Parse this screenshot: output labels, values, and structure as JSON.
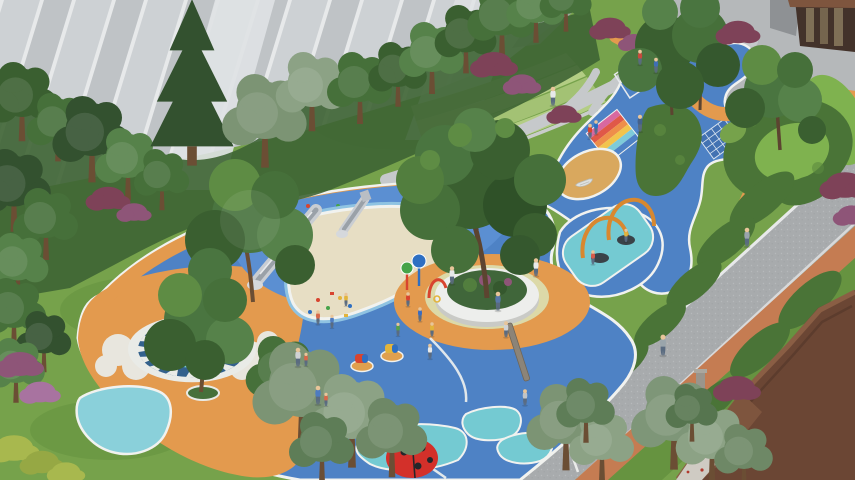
{
  "meta": {
    "title": "Residential courtyard children's playground — aerial 3D architectural rendering",
    "type": "3d-architectural-rendering",
    "view": "aerial-oblique"
  },
  "palette": {
    "grass": "#76A24B",
    "grass_dark": "#65913F",
    "lawn_bright": "#7FB24F",
    "terrace_light": "#B3CD84",
    "terrace_mid": "#A3C274",
    "terrace_dark": "#9CBB6E",
    "facade_base": "#C8CCCF",
    "facade_panel_a": "#CDD1D4",
    "facade_panel_b": "#BFC3C6",
    "facade_seam": "#E7E9EA",
    "facade_pillar": "#DFE2E4",
    "paving": "#B5B8BA",
    "path_grey": "#C6C9CB",
    "road": "#A8ABAD",
    "road_kerb": "#E8E9EA",
    "track_orange": "#C57C52",
    "play_blue": "#4E82C5",
    "hill_blue": "#5B8FD2",
    "deep_blue": "#2C64B0",
    "navy_ring": "#33618C",
    "teal": "#74CAD2",
    "teal_light": "#8AD0DA",
    "sand": "#E7DEC4",
    "sand_tan": "#D9A85E",
    "orange": "#E39A4E",
    "edge_white": "#F1F2EF",
    "cloud_white": "#E9EBE7",
    "hedge": "#4A7437",
    "hedge_light": "#5C8A40",
    "canopy_dark": "#3A5F30",
    "canopy_mid": "#46703A",
    "canopy_light": "#56824A",
    "canopy_pale": "#7C9474",
    "canopy_grey": "#8CA285",
    "conifer": "#33512F",
    "trunk_brown": "#6B4E34",
    "shrub_red": "#7E4258",
    "shrub_purple": "#8E5578",
    "bush_yellow": "#A8B84E",
    "roof_brown": "#6B4634",
    "roof_light": "#7E553E",
    "wood_dark": "#43322A",
    "glass_tint": "#8A7A5E",
    "metal_light": "#C9CDD2",
    "metal_dark": "#9AA1A8",
    "equip_red": "#D8442F",
    "equip_blue": "#2E6FC2",
    "equip_green": "#46A349",
    "equip_yellow": "#E2B43C",
    "arch_orange": "#D8882F",
    "ladybug_red": "#D3302A",
    "black": "#24262A",
    "skin": "#E8C59A",
    "white_shirt": "#E8EAEB",
    "mat_0": "#D868A0",
    "mat_1": "#E05848",
    "mat_2": "#EE8E4A",
    "mat_3": "#F2C44C",
    "mat_4": "#7ECBD9",
    "mat_5": "#4E82C5",
    "hold_0": "#D8442F",
    "hold_1": "#E2B43C",
    "hold_2": "#46A349",
    "hold_3": "#F0F1EE"
  },
  "scene": {
    "setting": "residential courtyard between apartment towers",
    "surfaces": [
      "blue rubber playground surface",
      "orange rubber surface",
      "sand pit",
      "terraced lawn",
      "asphalt road",
      "terracotta jogging track",
      "grey footpaths"
    ],
    "play_equipment": [
      "twin stainless steel embankment slides",
      "climbing hill with holds",
      "water spray posts",
      "spring riders",
      "basket swings on orange arches",
      "rainbow climbing mat",
      "balance beam",
      "toy boat",
      "shark-teeth amphitheater ring",
      "ladybug sculpture",
      "sphere sculpture",
      "tomato sculpture"
    ],
    "vegetation": [
      "dense tree band",
      "hedge islands",
      "C-shaped hedge ring with lawn",
      "red-leaf shrubs",
      "purple flowering shrubs"
    ],
    "buildings": [
      "grey apartment facade (top-left)",
      "brown entrance lobby (top-right)",
      "brown pitched roof (bottom-right)"
    ]
  }
}
